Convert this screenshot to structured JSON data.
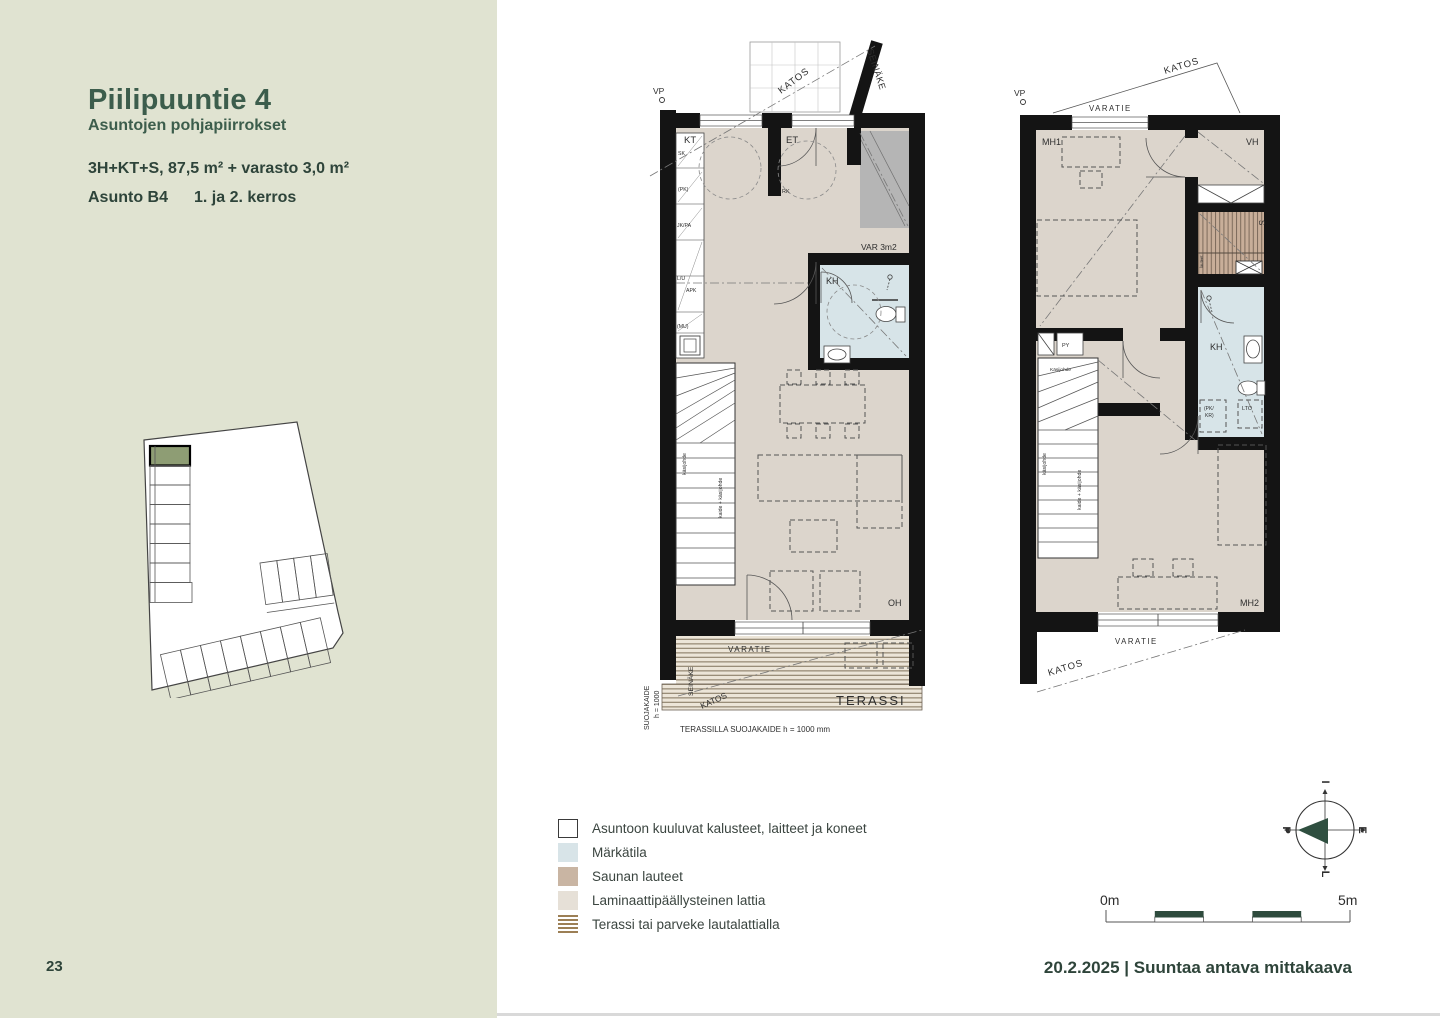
{
  "colors": {
    "sidebar_bg": "#e0e3d1",
    "accent_green": "#3c5d4c",
    "text_green": "#2e443a",
    "wall": "#141414",
    "laminate": "#dcd5cc",
    "wet_room": "#d7e4e8",
    "sauna": "#c8ae99",
    "storage_gray": "#b5b5b5",
    "site_highlight": "#8e9d74",
    "terrace_stripe": "#9c7f55"
  },
  "sidebar": {
    "title": "Piilipuuntie 4",
    "subtitle": "Asuntojen pohjapiirrokset",
    "spec": "3H+KT+S, 87,5 m² + varasto 3,0 m²",
    "apartment": "Asunto B4",
    "floors": "1. ja 2. kerros",
    "page_number": "23"
  },
  "plan1": {
    "vp": "VP",
    "katos_top": "KATOS",
    "seinake_top": "SEINÄKE",
    "kt": "KT",
    "et": "ET",
    "rk": "RK",
    "var": "VAR 3m2",
    "kh": "KH",
    "kitchen_units": [
      "SK",
      "(PK)",
      "JK/PA",
      "L/U",
      "APK",
      "(MU)"
    ],
    "stair_label_1": "käsijohde",
    "stair_label_2": "kaide + käsijohde",
    "oh": "OH",
    "varatie": "VARATIE",
    "seinake_bottom": "SEINÄKE",
    "katos_bottom": "KATOS",
    "terassi": "TERASSI",
    "guard_side_1": "SUOJAKAIDE",
    "guard_side_2": "h = 1000",
    "terrace_note": "TERASSILLA SUOJAKAIDE h = 1000 mm"
  },
  "plan2": {
    "vp": "VP",
    "katos_top": "KATOS",
    "varatie_top": "VARATIE",
    "mh1": "MH1",
    "vh": "VH",
    "s": "S",
    "lauteet": "lauteet",
    "py": "PY",
    "kh": "KH",
    "pk_kr_1": "(PK/",
    "pk_kr_2": "KR)",
    "lto": "LTO",
    "kasijohde_top": "Käsijohde",
    "stair_label_1": "käsijohde",
    "stair_label_2": "kaide + käsijohde",
    "mh2": "MH2",
    "varatie_bottom": "VARATIE",
    "katos_bottom": "KATOS"
  },
  "legend": {
    "items": [
      {
        "label": "Asuntoon kuuluvat kalusteet, laitteet ja koneet",
        "swatch": "fixtures"
      },
      {
        "label": "Märkätila",
        "swatch": "wet"
      },
      {
        "label": "Saunan lauteet",
        "swatch": "sauna"
      },
      {
        "label": "Laminaattipäällysteinen lattia",
        "swatch": "laminate"
      },
      {
        "label": "Terassi tai parveke lautalattialla",
        "swatch": "terrace"
      }
    ]
  },
  "compass": {
    "top": "I",
    "right": "E",
    "bottom": "L",
    "left": "P"
  },
  "scale_bar": {
    "start": "0m",
    "end": "5m"
  },
  "footer": {
    "text": "20.2.2025 | Suuntaa antava mittakaava"
  }
}
